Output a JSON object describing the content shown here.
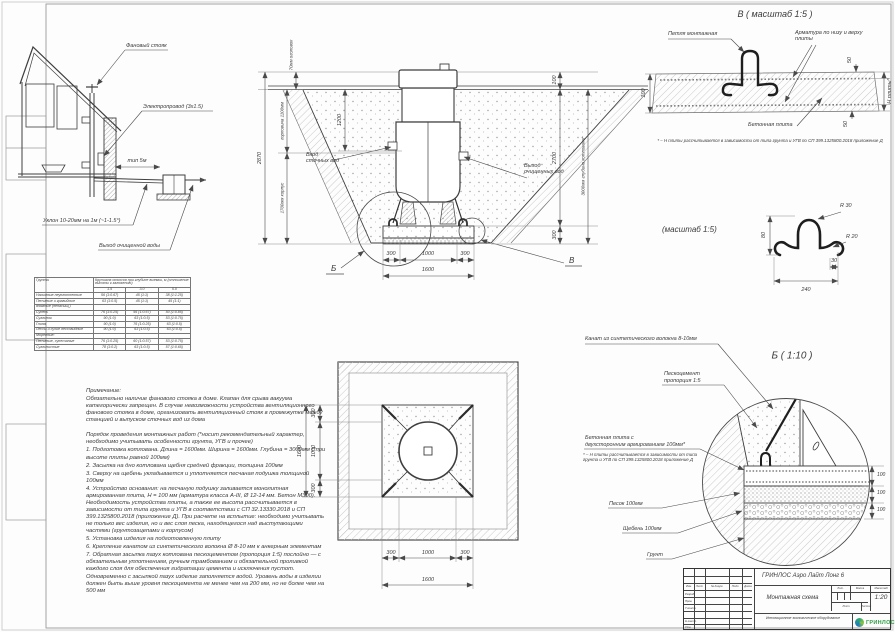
{
  "house": {
    "stack": "Фановый стояк",
    "wire": "Электропровод (3х1.5)",
    "dist": "тип 5м",
    "slope": "Уклон 10-20мм на 1м (~1-1.5°)",
    "outlet": "Выход очищенной воды"
  },
  "soil_table": {
    "col_soil": "Грунты",
    "col_header": "Крутизна откосов при глубине выемки, м (отношение высоты к заложению)",
    "depths": [
      "1.5",
      "3.0",
      "5.0"
    ],
    "rows": [
      {
        "name": "Насыпные неуплотненные",
        "v1": "56 (1:0.67)",
        "v2": "45 (1:1)",
        "v3": "38 (1:1.25)"
      },
      {
        "name": "Песчаные и гравийные",
        "v1": "63 (1:0.5)",
        "v2": "45 (1:1)",
        "v3": "45 (1:1)"
      },
      {
        "name": "влажные (ненасыщ.)",
        "v1": "",
        "v2": "",
        "v3": ""
      },
      {
        "name": "Супесь",
        "v1": "76 (1:0.25)",
        "v2": "56 (1:0.67)",
        "v3": "50 (1:0.85)"
      },
      {
        "name": "Суглинок",
        "v1": "90 (1:0)",
        "v2": "63 (1:0.5)",
        "v3": "53 (1:0.75)"
      },
      {
        "name": "Глина",
        "v1": "90 (1:0)",
        "v2": "76 (1:0.25)",
        "v3": "63 (1:0.5)"
      },
      {
        "name": "Лессы и сухие лессовидные",
        "v1": "90 (1:0)",
        "v2": "63 (1:0.5)",
        "v3": "63 (1:0.5)"
      },
      {
        "name": "Моренные:",
        "v1": "",
        "v2": "",
        "v3": ""
      },
      {
        "name": "Песчаные, супесчаные",
        "v1": "76 (1:0.25)",
        "v2": "60 (1:0.57)",
        "v3": "53 (1:0.75)"
      },
      {
        "name": "Суглинистые",
        "v1": "78 (1:0.2)",
        "v2": "63 (1:0.5)",
        "v3": "57 (1:0.65)"
      }
    ]
  },
  "notes": {
    "title": "Примечание:",
    "p1": "Обязательно наличие фанового стояка в доме. Клапан для срыва вакуума категорически запрещен. В случае невозможности устройства вентиляционного фанового стояка в доме, организовать вентиляционный стояк в промежутке между станцией и выпуском сточных вод из дома",
    "p2": "Порядок проведения монтажных работ (*носит рекомендательный характер, необходимо учитывать особенности грунта, УГВ и прочее)",
    "items": [
      "1. Подготовка котлована. Длина = 1600мм. Ширина = 1600мм. Глубина = 3000мм (*при высоте плиты равной 100мм)",
      "2. Засыпка на дно котлована щебня средней фракции, толщина 100мм",
      "3. Сверху на щебень укладывается и уплотняется песчаная подушка толщиной 100мм",
      "4. Устройство основания: на песчаную подушку заливается монолитная армированная плита, Н = 100 мм (арматура класса А-III, Ø 12-14 мм. Бетон М300). Необходимость устройства плиты, а также ее высота рассчитывается в зависимости от типа грунта и УГВ в соответствии с СП 32.13330.2018 и СП 399.1325800.2018 (приложение Д). При расчете на всплытие: необходимо учитывать не только вес изделия, но и вес слоя песка, находящегося над выступающими частями (грунтозацепами и корпусом)",
      "5. Установка изделия на подготовленную плиту",
      "6. Крепление канатом из синтетического волокна Ø 8-10 мм к анкерным элементам",
      "7. Обратная засыпка пазух котлована пескоцементом (пропорция 1:5) послойно — с обязательным уплотнением, ручным трамбованием и обязательной проливкой каждого слоя для обеспечения гидратации цемента и исключения пустот. Одновременно с засыпкой пазух изделие заполняется водой. Уровень воды в изделии должен быть выше уровня пескоцемента не менее чем на 200 мм, но не более чем на 500 мм"
    ]
  },
  "section": {
    "dims": {
      "cap": "70мм оголовок",
      "neck": "горловина 1100мм",
      "total": "2870",
      "inlet": "1200",
      "body": "1700мм корпус",
      "top100": "100",
      "d2700": "2700",
      "depth": "3000мм глубина котлована*",
      "d300": "300",
      "d1000": "1000",
      "d1600": "1600"
    },
    "labels": {
      "in": "Вход сточных вод",
      "out": "Выход очищенных вод",
      "mark_b": "Б",
      "mark_v": "В"
    }
  },
  "detail_v": {
    "title": "В ( масштаб 1:5 )",
    "loop": "Петля монтажная",
    "rebar": "Арматура по низу и верху плиты",
    "slab": "Бетонная плита",
    "d100": "100",
    "d50": "50",
    "dh": "Н плиты*",
    "note": "* – Н плиты рассчитывается в зависимости от типа грунта и УГВ по СП 399.1325800.2018 приложение Д"
  },
  "hook": {
    "title": "(масштаб 1:5)",
    "r30": "R 30",
    "r20": "R 20",
    "d80": "80",
    "d240": "240",
    "d30": "30"
  },
  "detail_b": {
    "title": "Б ( 1:10 )",
    "rope": "Канат из синтетического волокна 8-10мм",
    "sc1": "Пескоцемент",
    "sc2": "пропорция 1:5",
    "slab1": "Бетонная плита с",
    "slab2": "двухсторонним армированием 100мм*",
    "note": "* – Н плиты рассчитывается в зависимости от типа грунта и УГВ по СП 399.1325800.2018 приложение Д",
    "sand": "Песок 100мм",
    "gravel": "Щебень 100мм",
    "soil": "Грунт",
    "d100": "100"
  },
  "plan": {
    "d300": "300",
    "d1000": "1000",
    "d1600": "1600"
  },
  "titleblock": {
    "doc": "ГРИНЛОС Аэро Лайт Лонг 6",
    "name": "Монтажная схема",
    "scale": "1:20",
    "h_lit": "Лит.",
    "h_mass": "Масса",
    "h_scale": "Масштаб",
    "h_sheet": "Лист",
    "h_sheets": "Листов",
    "cols": {
      "izm": "Изм.",
      "list": "Лист",
      "doc": "№ докум.",
      "sign": "Подп.",
      "date": "Дата"
    },
    "rows": {
      "dev": "Разраб.",
      "check": "Пров.",
      "tcontr": "Т.контр.",
      "ncontr": "Н.контр.",
      "approve": "Утв."
    },
    "tagline": "Инновационное экологическое оборудование",
    "brand": "ГРИНЛОС",
    "brand_color": "#2f9e44"
  }
}
